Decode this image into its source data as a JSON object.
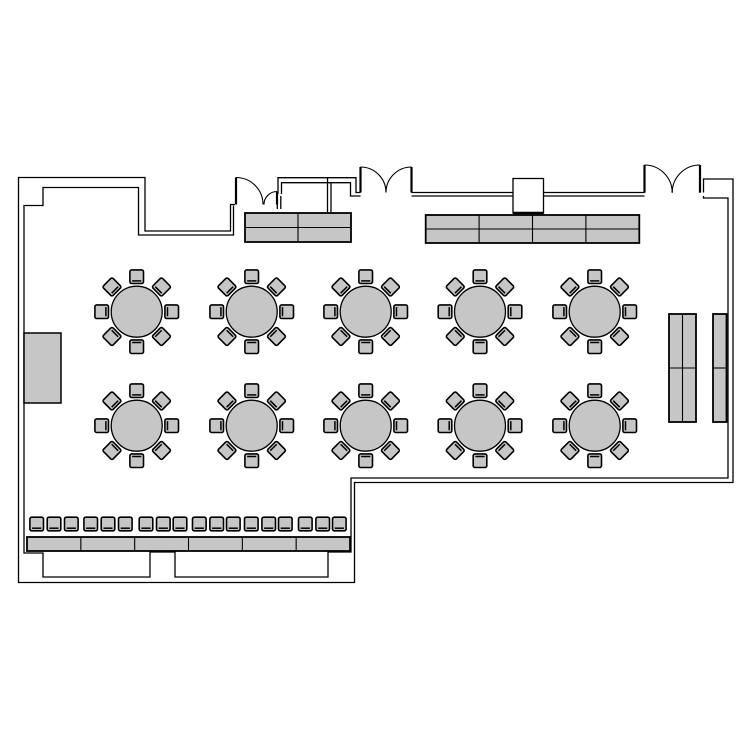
{
  "title": "banquet-room-floor-plan",
  "canvas": {
    "width": 750,
    "height": 750,
    "background": "#ffffff"
  },
  "colors": {
    "wall_line": "#000000",
    "furniture_fill": "#c6c6c6",
    "furniture_stroke": "#000000",
    "floor_fill": "#ffffff"
  },
  "style": {
    "wall_width": 1.3,
    "table_stroke_width": 1.3,
    "chair_stroke_width": 1.6,
    "chair_back_width": 1.5,
    "block_outer_width": 1.8,
    "block_divider_width": 1.1,
    "door_leaf_width": 2.2,
    "door_arc_width": 1.1
  },
  "walls": {
    "outer_loop": [
      [
        235,
        204.5
      ],
      [
        230.5,
        204.5
      ],
      [
        230.5,
        231
      ],
      [
        145,
        231
      ],
      [
        145,
        177.5
      ],
      [
        18.5,
        177.5
      ],
      [
        18.5,
        582.5
      ],
      [
        354.5,
        582.5
      ],
      [
        354.5,
        482.5
      ],
      [
        733,
        482.5
      ],
      [
        733,
        179
      ],
      [
        703.5,
        179
      ],
      [
        703.5,
        192.5
      ]
    ],
    "inner_loop": [
      [
        233.5,
        205.5
      ],
      [
        233.5,
        235
      ],
      [
        138.5,
        235
      ],
      [
        138.5,
        187.5
      ],
      [
        43,
        187.5
      ],
      [
        43,
        205.5
      ],
      [
        24,
        205.5
      ],
      [
        24,
        553
      ],
      [
        43,
        553
      ],
      [
        43,
        577
      ],
      [
        150,
        577
      ],
      [
        150,
        552
      ],
      [
        175,
        552
      ],
      [
        175,
        577
      ],
      [
        328,
        577
      ],
      [
        328,
        552
      ],
      [
        351,
        552
      ],
      [
        351,
        478
      ],
      [
        728,
        478
      ],
      [
        728,
        198
      ],
      [
        703.5,
        198
      ],
      [
        703.5,
        196
      ]
    ],
    "alcove_outer": [
      [
        278,
        194
      ],
      [
        278,
        177.7
      ],
      [
        356,
        177.7
      ],
      [
        356,
        192.5
      ],
      [
        360.5,
        192.5
      ]
    ],
    "alcove_inner": [
      [
        281.5,
        194
      ],
      [
        281.5,
        182.7
      ],
      [
        350.5,
        182.7
      ],
      [
        350.5,
        196
      ],
      [
        360.5,
        196
      ]
    ],
    "alcove_divider_a": [
      [
        327.5,
        178
      ],
      [
        327.5,
        212
      ]
    ],
    "alcove_divider_b": [
      [
        331,
        183
      ],
      [
        331,
        212
      ]
    ],
    "jamb_stub_a": [
      [
        277.3,
        194
      ],
      [
        277.3,
        209
      ]
    ],
    "jamb_stub_b": [
      [
        280.8,
        196
      ],
      [
        280.8,
        209
      ]
    ],
    "band_top": [
      [
        411.5,
        192.5
      ],
      [
        644.5,
        192.5
      ]
    ],
    "band_bottom": [
      [
        411.5,
        196
      ],
      [
        644.5,
        196
      ]
    ]
  },
  "pillar": {
    "x": 513,
    "y": 178.5,
    "w": 30.5,
    "h": 34.5
  },
  "doors": [
    {
      "name": "single-door-top-left",
      "leaves": [
        [
          [
            236,
            177.5
          ],
          [
            236,
            204.5
          ]
        ],
        [
          [
            277,
            191.5
          ],
          [
            277,
            204.5
          ]
        ]
      ],
      "arcs": [
        "M 236 177.5 A 27 27 0 0 1 263 204.5",
        "M 277 191.5 A 13 13 0 0 0 264 204.5"
      ]
    },
    {
      "name": "double-door-top-center",
      "leaves": [
        [
          [
            360.5,
            167
          ],
          [
            360.5,
            192.5
          ]
        ],
        [
          [
            411.5,
            167
          ],
          [
            411.5,
            192.5
          ]
        ]
      ],
      "arcs": [
        "M 360.5 167 A 25.5 25.5 0 0 1 386 192.5",
        "M 411.5 167 A 25.5 25.5 0 0 0 386 192.5"
      ]
    },
    {
      "name": "double-door-top-right",
      "leaves": [
        [
          [
            644.5,
            165
          ],
          [
            644.5,
            192.7
          ]
        ],
        [
          [
            700,
            165
          ],
          [
            700,
            192.7
          ]
        ]
      ],
      "arcs": [
        "M 644.5 165 A 27.7 27.7 0 0 1 672.2 192.7",
        "M 700 165 A 27.7 27.7 0 0 0 672.2 192.7"
      ]
    }
  ],
  "round_tables": {
    "radius": 25.5,
    "chair_distance": 35,
    "chair_size": 13.6,
    "chair_angles": [
      0,
      45,
      90,
      135,
      180,
      225,
      270,
      315
    ],
    "centers": [
      [
        136.7,
        311.7
      ],
      [
        251.7,
        311.7
      ],
      [
        365.7,
        311.7
      ],
      [
        480.0,
        311.7
      ],
      [
        594.7,
        311.7
      ],
      [
        136.7,
        425.7
      ],
      [
        251.7,
        425.7
      ],
      [
        365.7,
        425.7
      ],
      [
        480.0,
        425.7
      ],
      [
        594.7,
        425.7
      ]
    ]
  },
  "buffet_tables": [
    {
      "name": "buffet-table-left",
      "x": 245,
      "y": 213,
      "w": 106,
      "h": 29,
      "cols": 2,
      "rows": 2
    },
    {
      "name": "buffet-table-right",
      "x": 425.7,
      "y": 215,
      "w": 213.6,
      "h": 28,
      "cols": 4,
      "rows": 2
    }
  ],
  "side_tables": [
    {
      "name": "side-table-double",
      "x": 669,
      "y": 314,
      "w": 27,
      "h": 108,
      "cols": 2,
      "rows": 2
    },
    {
      "name": "side-table-single",
      "x": 713,
      "y": 314,
      "w": 13.5,
      "h": 108,
      "cols": 1,
      "rows": 2
    }
  ],
  "wall_counter": {
    "x": 24,
    "y": 333,
    "w": 37,
    "h": 70
  },
  "head_table_row": {
    "table": {
      "x": 27,
      "y": 537,
      "w": 323,
      "h": 14,
      "segments": 6
    },
    "chairs": {
      "center_y": 524,
      "size": 13.6,
      "centers_x": [
        36.7,
        54,
        71.3,
        90.7,
        108,
        125.3,
        146,
        163.3,
        180,
        199.3,
        216.7,
        233.3,
        251.3,
        268.7,
        285.3,
        305.3,
        322.7,
        339.3
      ]
    }
  }
}
